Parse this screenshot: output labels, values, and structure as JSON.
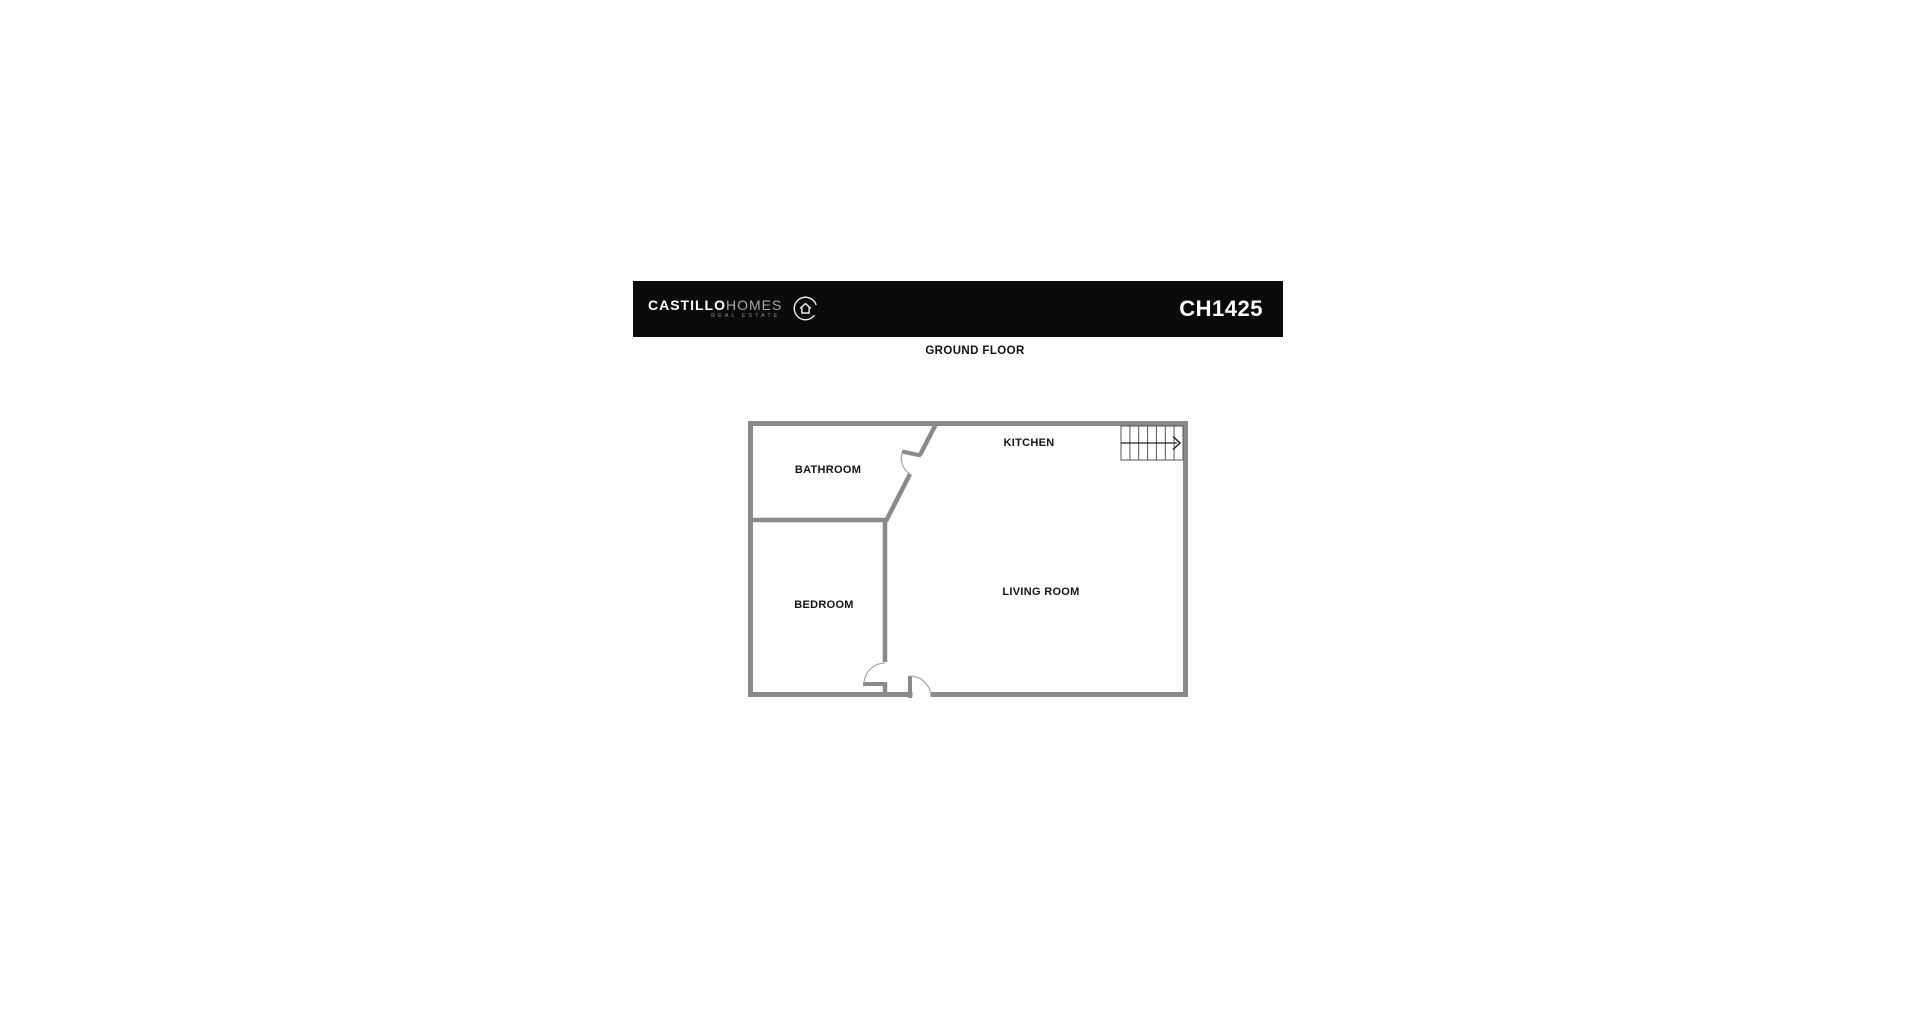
{
  "header": {
    "brand": {
      "name_bold": "CASTILLO",
      "name_light": "HOMES",
      "tagline": "REAL ESTATE",
      "icon": "house-in-circle-icon"
    },
    "listing_code": "CH1425",
    "bar_color": "#0a0a0a"
  },
  "floor": {
    "title": "GROUND FLOOR"
  },
  "floorplan": {
    "wall_color": "#8a8a8a",
    "arc_color": "#aaaaaa",
    "stairs_line_color": "#555555",
    "arrow_color": "#222222",
    "rooms": [
      {
        "name": "BATHROOM"
      },
      {
        "name": "KITCHEN"
      },
      {
        "name": "BEDROOM"
      },
      {
        "name": "LIVING ROOM"
      }
    ],
    "features": {
      "staircase": "stairs with right-pointing arrow, top-right corner",
      "doors": [
        "bathroom door in diagonal wall",
        "bedroom door at bottom of divider wall",
        "entry door in bottom wall"
      ]
    }
  }
}
